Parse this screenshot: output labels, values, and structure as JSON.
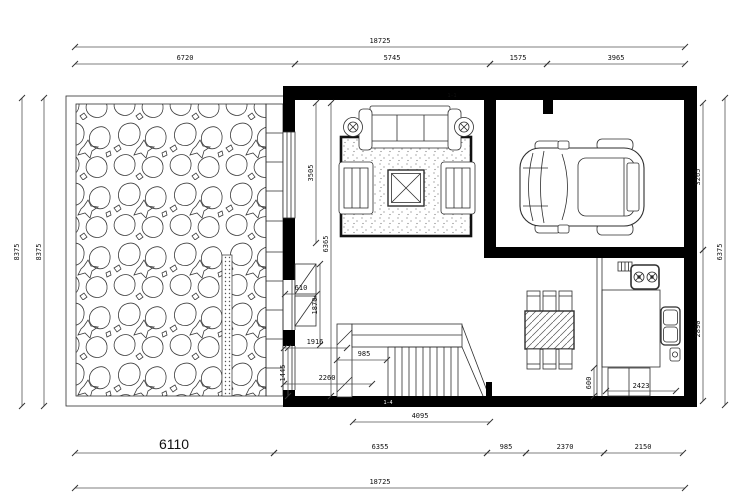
{
  "colors": {
    "ink": "#1f1f1f",
    "dim_line": "#555555",
    "wall": "#000000"
  },
  "drawing": {
    "dims": {
      "top_total": "18725",
      "top_seg1": "6720",
      "top_seg2": "5745",
      "top_seg3": "1575",
      "top_seg4": "3965",
      "left_outer": "8375",
      "left_inner": "8375",
      "right_seg_top": "3265",
      "right_seg_bottom": "2890",
      "right_outer": "6375",
      "bottom_total": "18725",
      "bottom_seg1": "6110",
      "bottom_seg2": "6355",
      "bottom_seg3": "985",
      "bottom_seg4": "2370",
      "bottom_seg5": "2150",
      "stair_run": "4095",
      "stair_width": "985",
      "living_height": "3505",
      "interior_long": "6365",
      "cabinet_depth": "610",
      "interior_v1": "1870",
      "interior_h1": "1916",
      "interior_v2": "1445",
      "interior_h2": "2260",
      "kitchen_counter": "2423",
      "kitchen_offset": "600"
    },
    "tags": {
      "top_wall": "1-1",
      "bottom_wall": "1-4"
    }
  }
}
